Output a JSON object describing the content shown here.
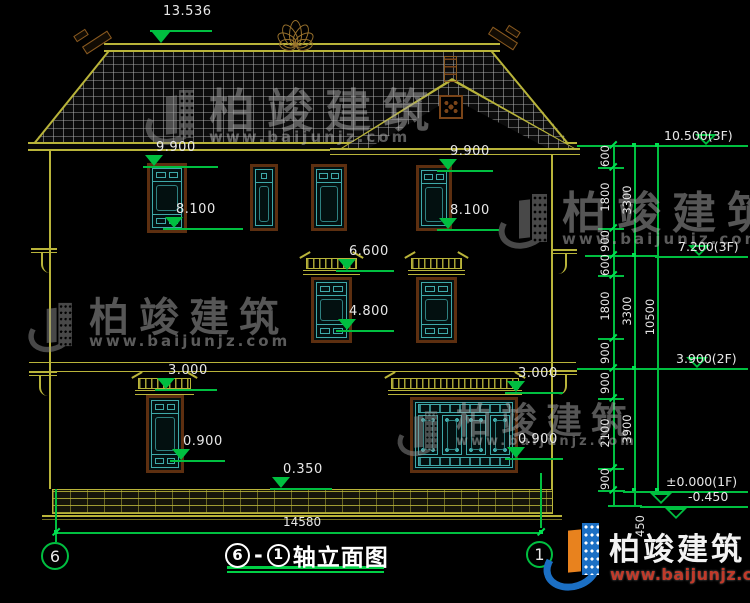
{
  "colors": {
    "background": "#000000",
    "cad_yellow": "#b9b43a",
    "cad_green": "#00bf40",
    "window_teal": "#3fa9a9",
    "frame_brown": "#5d2f10",
    "dim_text": "#e8e8e8",
    "brand_blue": "#1b6fc4",
    "brand_orange": "#e8821e",
    "brand_url_red": "#c03a2a"
  },
  "facade_markers": [
    "13.536",
    "9.900",
    "9.900",
    "8.100",
    "8.100",
    "6.600",
    "4.800",
    "3.000",
    "3.000",
    "0.900",
    "0.900",
    "0.350"
  ],
  "right_chain": {
    "col1": [
      "600",
      "1800",
      "900",
      "600",
      "1800",
      "900",
      "900",
      "2100",
      "900"
    ],
    "col2": [
      "3300",
      "3300",
      "3900"
    ],
    "col3": [
      "10500"
    ],
    "below_dim": "450",
    "levels": [
      "10.500(3F)",
      "7.200(3F)",
      "3.900(2F)",
      "±0.000(1F)",
      "-0.450"
    ]
  },
  "bottom": {
    "overall_dim": "14580",
    "axis_left": "6",
    "axis_right": "1"
  },
  "title": {
    "axis_start": "6",
    "dash": "-",
    "axis_end": "1",
    "name": "轴立面图"
  },
  "watermark": {
    "cn": "柏竣建筑",
    "url": "www.baijunjz.com"
  },
  "brand": {
    "cn": "柏竣建筑",
    "url": "www.baijunjz.com"
  }
}
